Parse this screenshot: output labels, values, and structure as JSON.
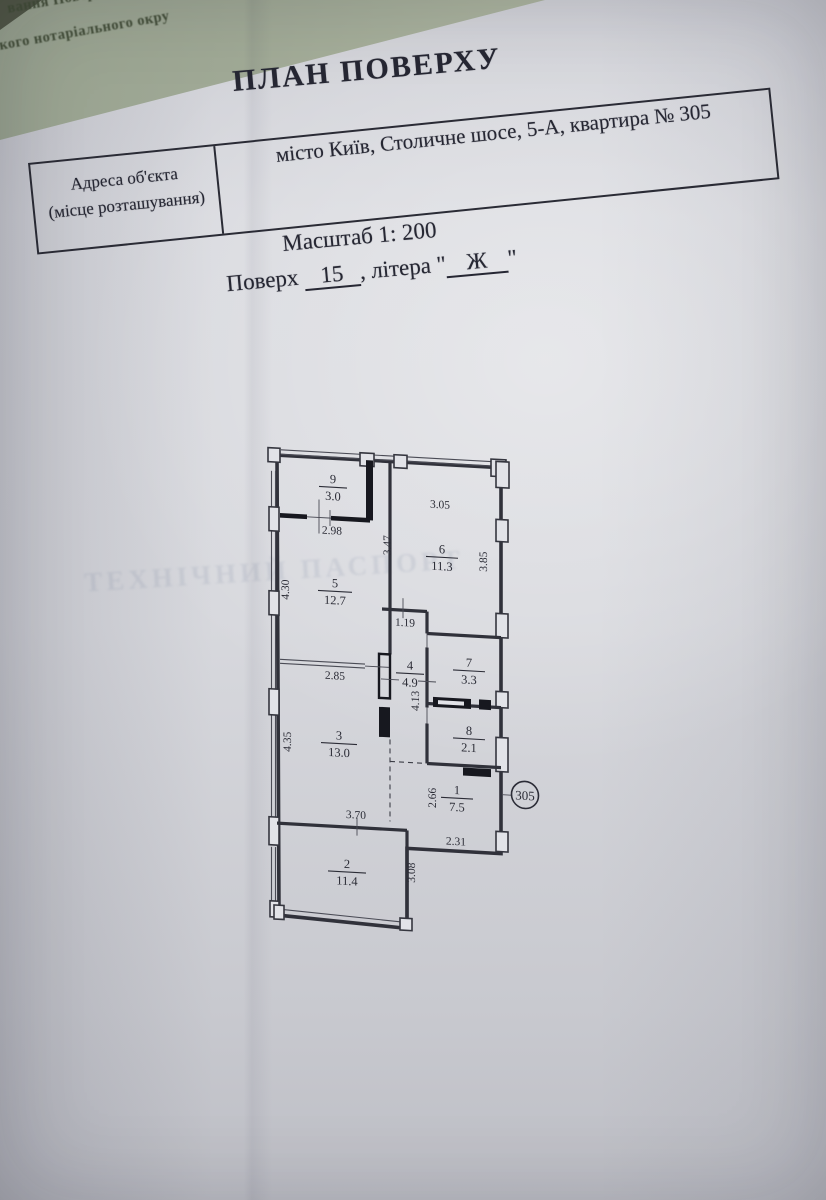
{
  "photo": {
    "underlay_line1": "вання Повер",
    "underlay_line2": "кого нотаріального окру",
    "bleed_text": "ТЕХНІЧНИЙ ПАСПОРТ"
  },
  "header": {
    "title": "ПЛАН ПОВЕРХУ",
    "address_label_line1": "Адреса об'єкта",
    "address_label_line2": "(місце розташування)",
    "address_value": "місто Київ, Столичне шосе, 5-А, квартира № 305",
    "scale_text": "Масштаб 1: 200",
    "floor_label": "Поверх",
    "floor_value": "15",
    "letter_label": ", літера",
    "quote_mark": "\"",
    "letter_value": "Ж"
  },
  "plan": {
    "apartment_number": "305",
    "rooms": [
      {
        "number": "1",
        "area": "7.5"
      },
      {
        "number": "2",
        "area": "11.4"
      },
      {
        "number": "3",
        "area": "13.0"
      },
      {
        "number": "4",
        "area": "4.9"
      },
      {
        "number": "5",
        "area": "12.7"
      },
      {
        "number": "6",
        "area": "11.3"
      },
      {
        "number": "7",
        "area": "3.3"
      },
      {
        "number": "8",
        "area": "2.1"
      },
      {
        "number": "9",
        "area": "3.0"
      }
    ],
    "dimensions": {
      "room6_top": "3.05",
      "balcony_width": "2.98",
      "room6_left": "3.47",
      "room6_right": "3.85",
      "room5_left": "4.30",
      "hallway": "1.19",
      "room5_bottom": "2.85",
      "room8_side": "4.13",
      "room3_left": "4.35",
      "room1_side": "2.66",
      "room1_bottom": "2.31",
      "room2_top": "3.70",
      "room2_right": "3.08"
    }
  }
}
